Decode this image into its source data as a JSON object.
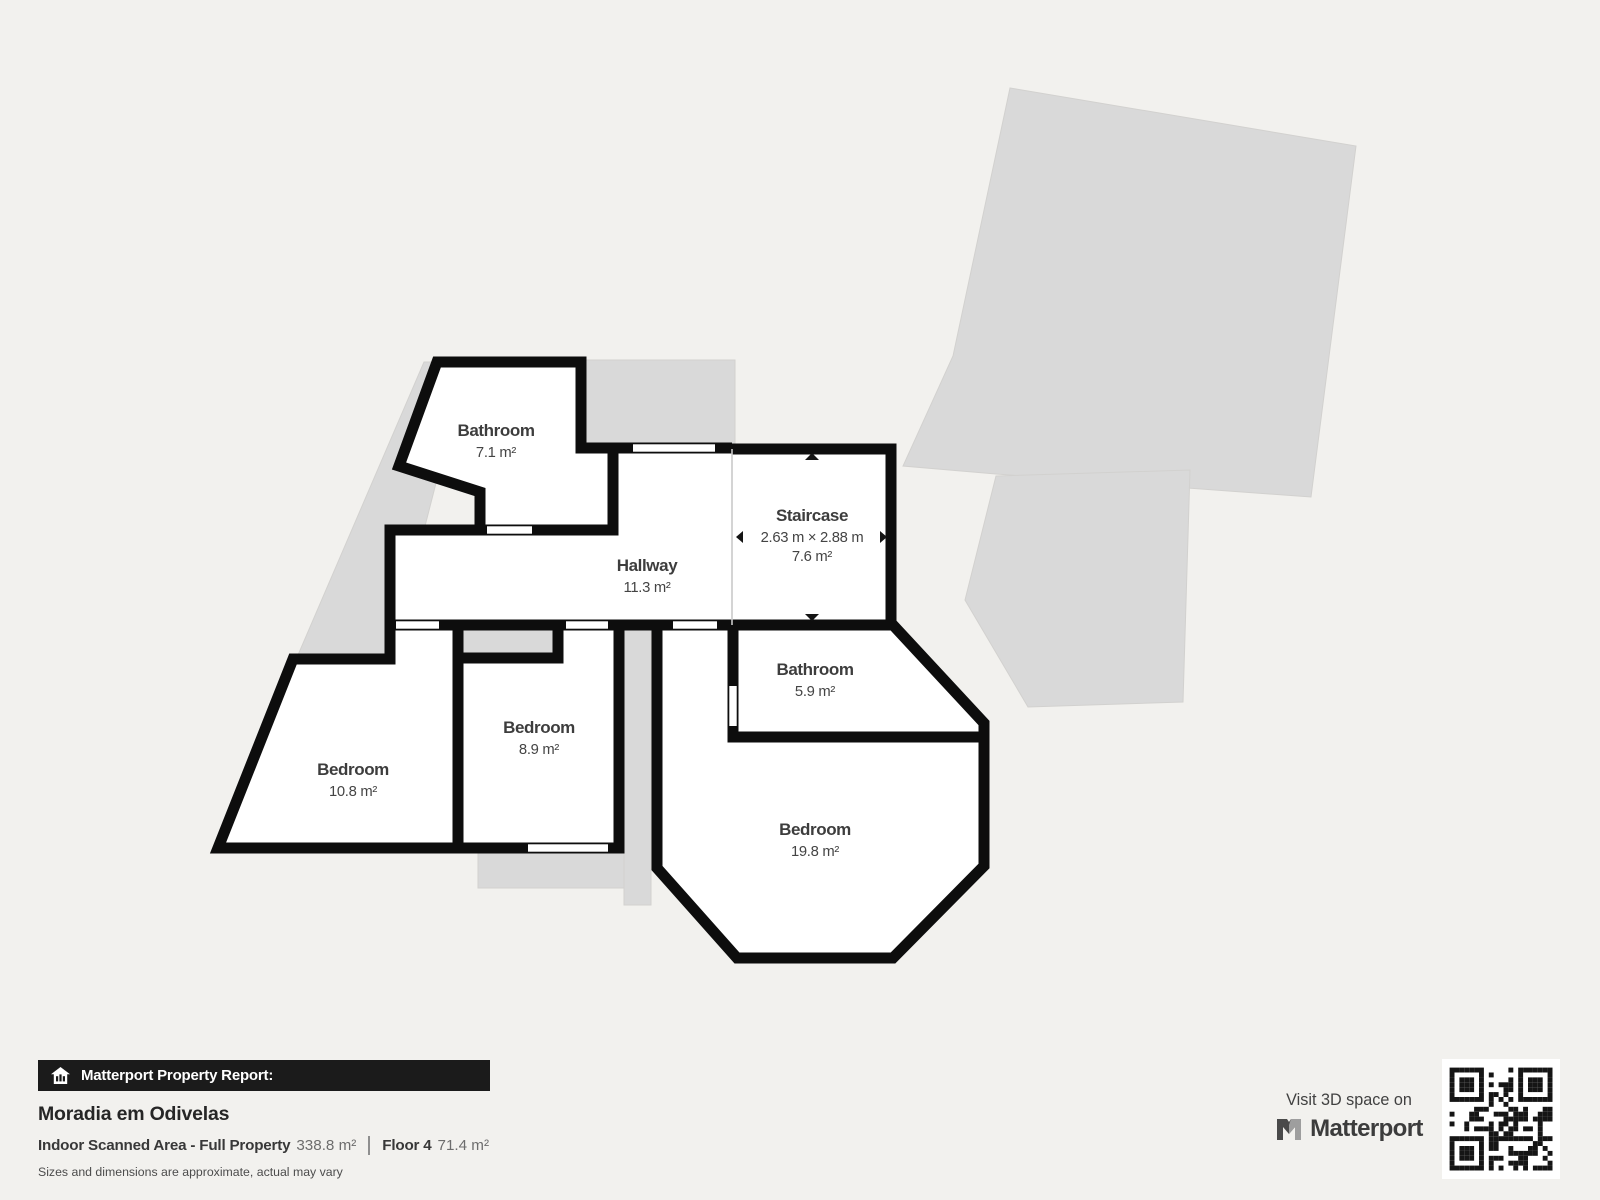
{
  "report": {
    "banner": "Matterport Property Report:",
    "title": "Moradia em Odivelas",
    "scanned_area_label": "Indoor Scanned Area - Full Property",
    "scanned_area_value": "338.8 m²",
    "floor_label": "Floor 4",
    "floor_value": "71.4 m²",
    "disclaimer": "Sizes and dimensions are approximate, actual may vary"
  },
  "promo": {
    "visit_text": "Visit 3D space on",
    "brand": "Matterport"
  },
  "floorplan": {
    "floor_number": "4",
    "rooms": {
      "bathroom_top": {
        "name": "Bathroom",
        "area": "7.1 m²"
      },
      "staircase": {
        "name": "Staircase",
        "dimensions": "2.63 m × 2.88 m",
        "area": "7.6 m²"
      },
      "hallway": {
        "name": "Hallway",
        "area": "11.3 m²"
      },
      "bathroom_lower": {
        "name": "Bathroom",
        "area": "5.9 m²"
      },
      "bedroom_middle": {
        "name": "Bedroom",
        "area": "8.9 m²"
      },
      "bedroom_left": {
        "name": "Bedroom",
        "area": "10.8 m²"
      },
      "bedroom_large": {
        "name": "Bedroom",
        "area": "19.8 m²"
      }
    },
    "colors": {
      "wall": "#0d0d0d",
      "room_fill": "#ffffff",
      "underlay": "#d9d9d9",
      "background": "#f2f1ee",
      "label_text": "#3d3d3d",
      "banner_bg": "#1b1b1b"
    }
  },
  "icons": {
    "banner": "house-chart-icon",
    "brand": "matterport-m-icon",
    "qr": "qr-code"
  }
}
